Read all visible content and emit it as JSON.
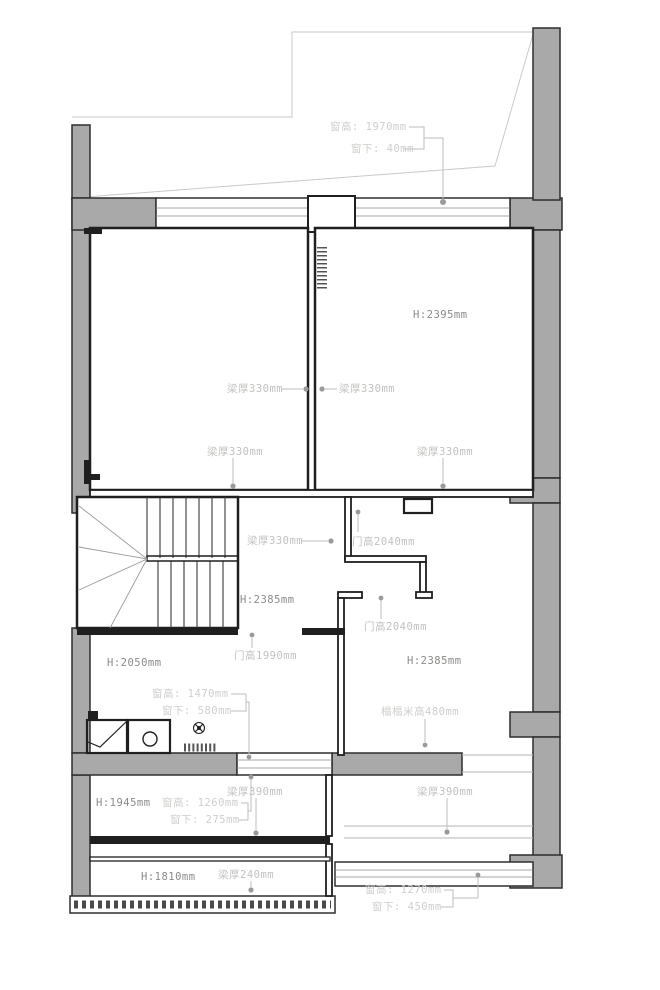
{
  "drawing_type": "floor-plan",
  "colors": {
    "wall_fill": "#a9a9a9",
    "wall_stroke": "#2e2e2e",
    "interior_line": "#1f1f1f",
    "construction_line": "#c9c9c9",
    "leader_line": "#bdbdbd",
    "leader_dot": "#9a9a9a",
    "label_light": "#c2c1bf",
    "label_dark": "#8a8a88",
    "background": "#ffffff"
  },
  "annotations": {
    "win_top_h": "窗高: 1970mm",
    "win_top_s": "窗下: 40mm",
    "h_room_tr": "H:2395mm",
    "beam330_a": "梁厚330mm",
    "beam330_b": "梁厚330mm",
    "beam330_c": "梁厚330mm",
    "beam330_d": "梁厚330mm",
    "beam330_e": "梁厚330mm",
    "door2040_a": "门高2040mm",
    "h_hall": "H:2385mm",
    "door2040_b": "门高2040mm",
    "door1990": "门高1990mm",
    "h_bath": "H:2050mm",
    "h_room_br": "H:2385mm",
    "win_mid_h": "窗高: 1470mm",
    "win_mid_s": "窗下: 580mm",
    "tatami": "榻榻米高480mm",
    "beam390_a": "梁厚390mm",
    "beam390_b": "梁厚390mm",
    "h_room_bl": "H:1945mm",
    "win_bl_h": "窗高: 1260mm",
    "win_bl_s": "窗下: 275mm",
    "h_strip": "H:1810mm",
    "beam240": "梁厚240mm",
    "win_br_h": "窗高: 1270mm",
    "win_br_s": "窗下: 450mm"
  }
}
